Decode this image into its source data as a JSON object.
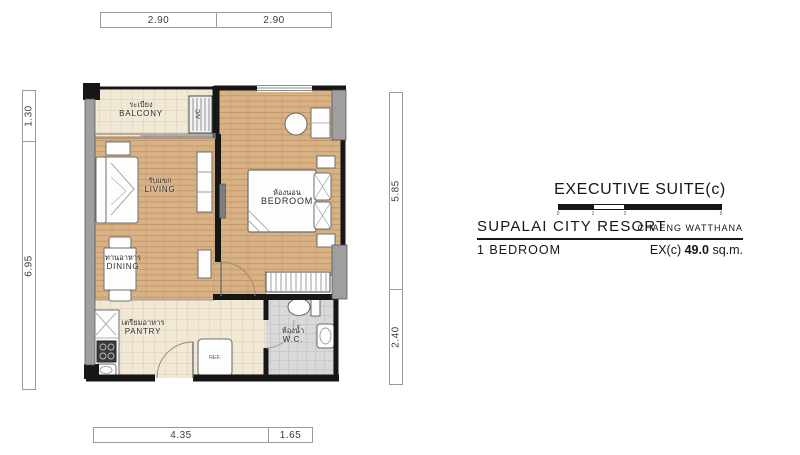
{
  "title_block": {
    "suite_name": "EXECUTIVE SUITE(c)",
    "project_name": "SUPALAI CITY RESORT",
    "location": "CHAENG WATTHANA",
    "unit_type": "1 BEDROOM",
    "area_prefix": "EX(c)",
    "area_value": "49.0",
    "area_unit": "sq.m.",
    "scale_ticks": [
      "0",
      "1",
      "2",
      "5"
    ]
  },
  "dimensions": {
    "top": [
      "2.90",
      "2.90"
    ],
    "bottom": [
      "4.35",
      "1.65"
    ],
    "left": [
      "1.30",
      "6.95"
    ],
    "right": [
      "5.85",
      "2.40"
    ]
  },
  "rooms": {
    "balcony": {
      "thai": "ระเบียง",
      "en": "BALCONY"
    },
    "living": {
      "thai": "รับแขก",
      "en": "LIVING"
    },
    "bedroom": {
      "thai": "ห้องนอน",
      "en": "BEDROOM"
    },
    "dining": {
      "thai": "ทานอาหาร",
      "en": "DINING"
    },
    "pantry": {
      "thai": "เตรียมอาหาร",
      "en": "PANTRY"
    },
    "wc": {
      "thai": "ห้องน้ำ",
      "en": "W.C."
    }
  },
  "fixtures": {
    "fridge": "REF.",
    "aircon": "A/C"
  },
  "colors": {
    "wood_floor": "#d8b184",
    "tile_floor": "#f1e9d6",
    "wc_tile": "#dadada",
    "wall": "#161616",
    "concrete": "#9f9f9f"
  }
}
